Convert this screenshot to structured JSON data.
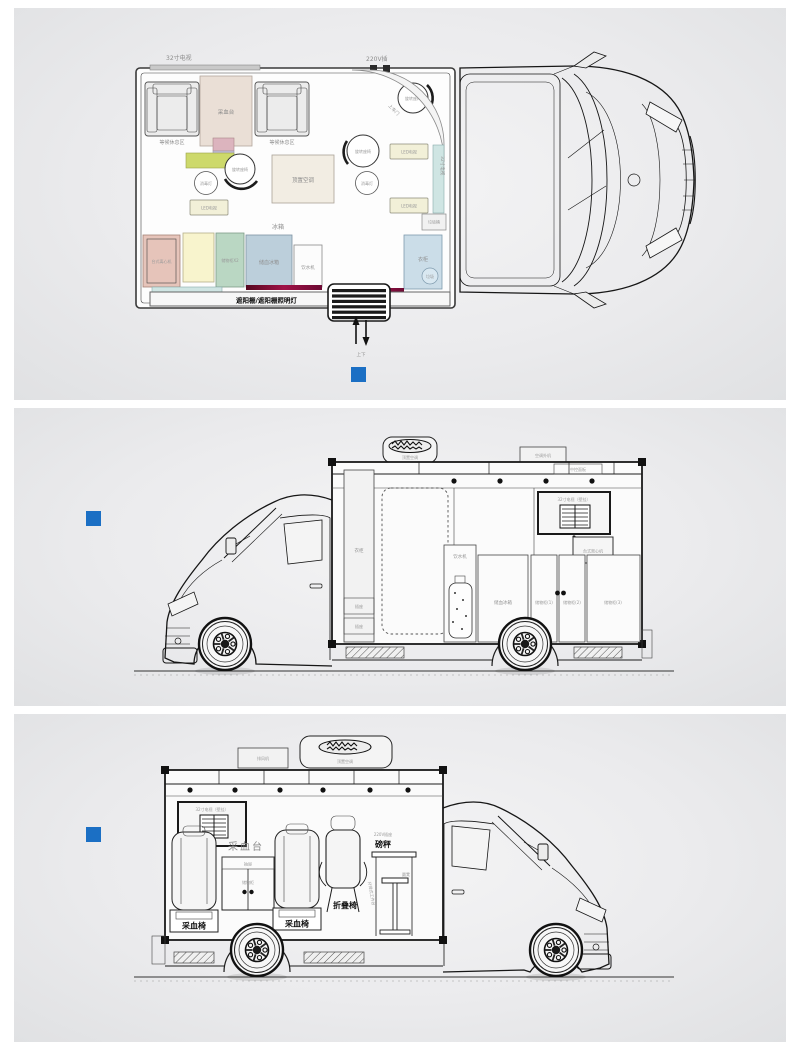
{
  "colors": {
    "accent_blue": "#1b6fc4",
    "rose": "#e6c4ba",
    "cream_yellow": "#f8f4cd",
    "mint_green": "#bad7c3",
    "blue_gray": "#bccfdb",
    "light_cyan": "#cfe5e3",
    "wardrobe_blue": "#cbdde8",
    "beige": "#eadfd6",
    "lime": "#cdd96b",
    "lavender": "#c6bedb",
    "pink_small": "#dcb4be",
    "cream_box": "#f2f0d8",
    "ac_beige": "#f2ede3"
  },
  "plan_view": {
    "tv_top_label": "32寸电视",
    "outlet_label": "220V插",
    "waiting_area_label": "等候休息区",
    "blood_station_label": "采血台",
    "swivel_seat_label": "旋转座椅",
    "disinfection_lamp_label": "消毒灯",
    "roof_ac_label": "顶置空调",
    "led_tv_label": "LED电视",
    "entry_door_label": "上车门",
    "side_tv_label": "32寸电视",
    "trash_bin_label": "垃圾桶",
    "fridge_label": "冰箱",
    "centrifuge_label": "台式离心机",
    "storage_x2_label": "储物柜X2",
    "blood_fridge_label": "储血冰箱",
    "water_dispenser_label": "饮水机",
    "wardrobe_label": "衣柜",
    "trash_label": "垃圾",
    "bottom_tv_label": "32寸电视",
    "awning_label": "遮阳棚/遮阳棚照明灯",
    "updown_label": "上下"
  },
  "left_side_view": {
    "roof_ac_label": "顶置空调",
    "ac_outdoor_label": "空调外机",
    "control_panel_label": "中控面板",
    "wardrobe_label": "衣柜",
    "socket_label": "插座",
    "wall_tv_label": "32寸电视（壁挂）",
    "centrifuge_label": "台式离心机",
    "water_dispenser_label": "饮水机",
    "blood_fridge_label": "储血冰箱",
    "cabinet1_label": "储物柜(1)",
    "cabinet2_label": "储物柜(2)",
    "cabinet3_label": "储物柜(3)"
  },
  "right_side_view": {
    "exhaust_fan_label": "排风机",
    "roof_ac_label": "顶置空调",
    "wall_tv_label": "32寸电视（壁挂）",
    "blood_station_label": "采血台",
    "drawer_label": "抽屉",
    "cabinet_label": "储物柜",
    "blood_chair_label": "采血椅",
    "folding_chair_label": "折叠椅",
    "scale_label": "磅秤",
    "outlet_label": "220V插座",
    "stool_label": "圆凳",
    "work_table_label": "升降式工作台"
  }
}
